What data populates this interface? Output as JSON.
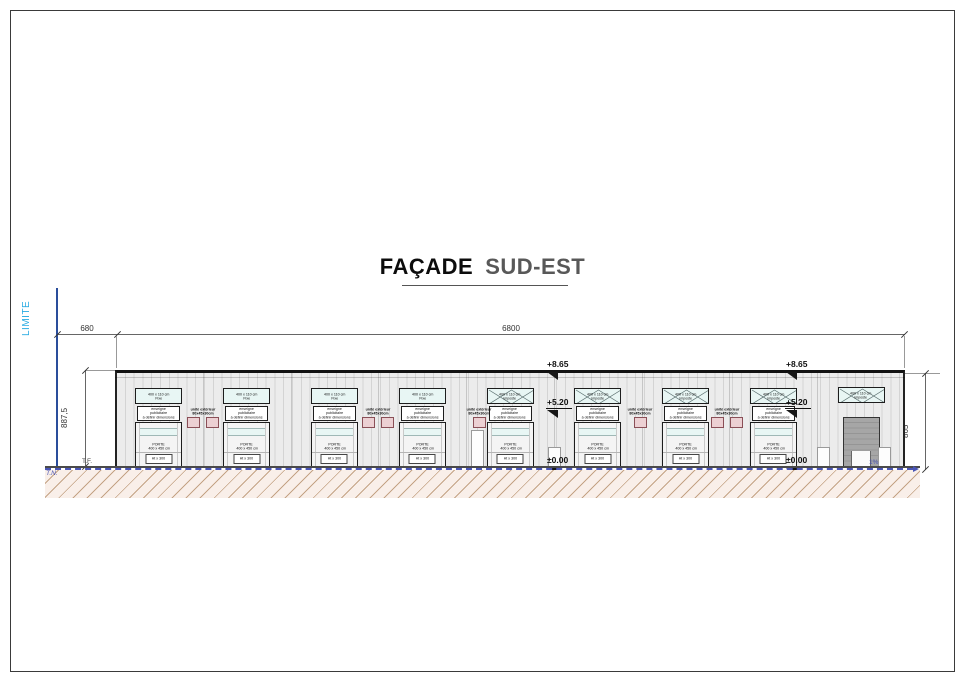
{
  "title": {
    "part1": "FAÇADE",
    "part2": "SUD-EST"
  },
  "side": {
    "limite": "LIMITE"
  },
  "dims": {
    "offset": "680",
    "total": "6800",
    "height_left": "887,5",
    "height_right": "865"
  },
  "levels": {
    "top": "+8.65",
    "mid": "+5.20",
    "zero": "±0.00"
  },
  "ground": {
    "tf": "T.F.",
    "tn": "T.N.",
    "slope": "1%"
  },
  "building": {
    "window_size": "400 x 110 cm",
    "sign_lines": [
      "enseigne",
      "publicitaire",
      "à définir dimensions"
    ],
    "door_label": "PORTE",
    "door_size": "400 x 450 cm",
    "door_badge": "Ht x 300",
    "unit_label": {
      "line1": "unité extérieur",
      "line2": "80x45x30cm"
    },
    "bays": [
      {
        "window_type": "Fixe",
        "pattern": "fixe",
        "has_sign": true,
        "door": "standard"
      },
      {
        "window_type": "Fixe",
        "pattern": "fixe",
        "has_sign": true,
        "door": "standard"
      },
      {
        "window_type": "Fixe",
        "pattern": "fixe",
        "has_sign": true,
        "door": "standard"
      },
      {
        "window_type": "Fixe",
        "pattern": "fixe",
        "has_sign": true,
        "door": "standard"
      },
      {
        "window_type": "imposte",
        "pattern": "imposte",
        "has_sign": true,
        "door": "standard"
      },
      {
        "window_type": "imposte",
        "pattern": "imposte",
        "has_sign": true,
        "door": "standard"
      },
      {
        "window_type": "imposte",
        "pattern": "imposte",
        "has_sign": true,
        "door": "standard"
      },
      {
        "window_type": "imposte",
        "pattern": "imposte",
        "has_sign": true,
        "door": "standard"
      },
      {
        "window_type": "imposte",
        "pattern": "imposte",
        "has_sign": false,
        "door": "sectional"
      }
    ],
    "units": [
      {
        "after_bay": 0,
        "count": 2
      },
      {
        "after_bay": 2,
        "count": 2
      },
      {
        "after_bay": 3,
        "count": 1
      },
      {
        "after_bay": 5,
        "count": 1
      },
      {
        "after_bay": 6,
        "count": 2
      }
    ]
  },
  "colors": {
    "accent": "#29abe2",
    "limite_line": "#2a4d9b",
    "tn": "#4a55b5",
    "facade": "#ececec",
    "window_fill": "#e8f6f4",
    "unit_fill": "#ecd0d3",
    "unit_border": "#8a4f57",
    "hatch_line": "#c4a385",
    "hatch_bg": "#f9efe9"
  }
}
